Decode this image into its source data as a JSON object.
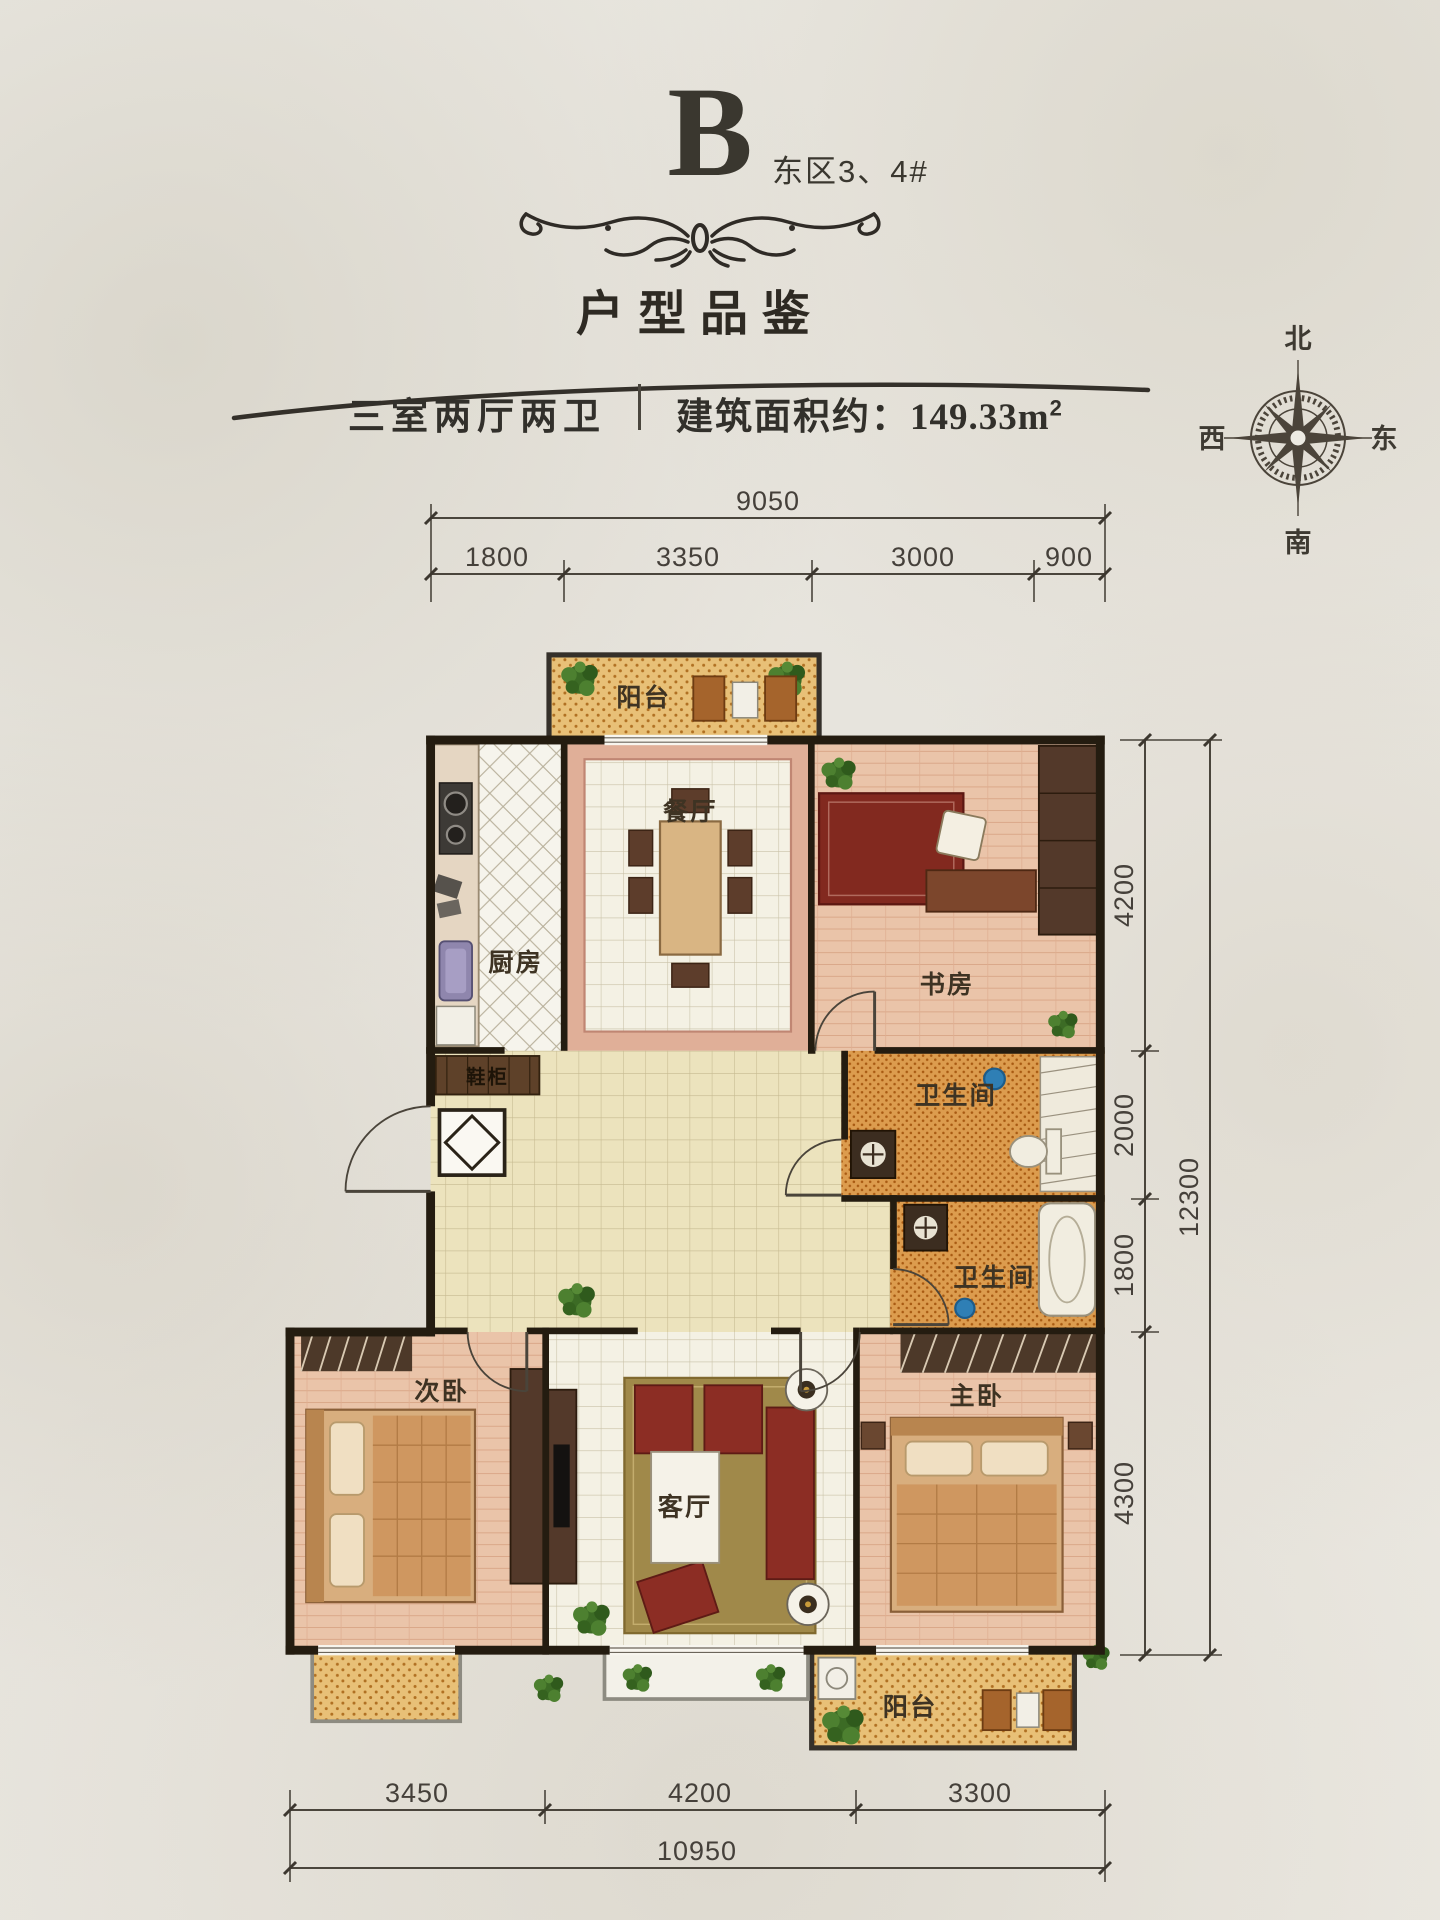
{
  "header": {
    "block_letter": "B",
    "block_note": "东区3、4#",
    "title": "户型品鉴",
    "spec_rooms": "三室两厅两卫",
    "spec_area_label": "建筑面积约：",
    "spec_area_value": "149.33m",
    "spec_area_sup": "2"
  },
  "compass": {
    "north": "北",
    "south": "南",
    "west": "西",
    "east": "东"
  },
  "rooms": {
    "balcony_top": "阳台",
    "kitchen": "厨房",
    "dining": "餐厅",
    "study": "书房",
    "bath1": "卫生间",
    "bath2": "卫生间",
    "shoe_cabinet": "鞋柜",
    "bedroom2": "次卧",
    "living": "客厅",
    "master": "主卧",
    "balcony_bottom": "阳台"
  },
  "dimensions": {
    "top": {
      "total": "9050",
      "segments": [
        "1800",
        "3350",
        "3000",
        "900"
      ]
    },
    "right": {
      "total": "12300",
      "segments": [
        "4200",
        "2000",
        "1800",
        "4300"
      ]
    },
    "bottom": {
      "total": "10950",
      "segments": [
        "3450",
        "4200",
        "3300"
      ]
    }
  },
  "colors": {
    "ink": "#35302a",
    "wall": "#241c10",
    "balcony_tile": "#e8c077",
    "bath_tile": "#dc9c4e",
    "wood_floor": "#eac4a9",
    "rug_olive": "#a0894a",
    "sofa_red": "#8c2d24"
  }
}
